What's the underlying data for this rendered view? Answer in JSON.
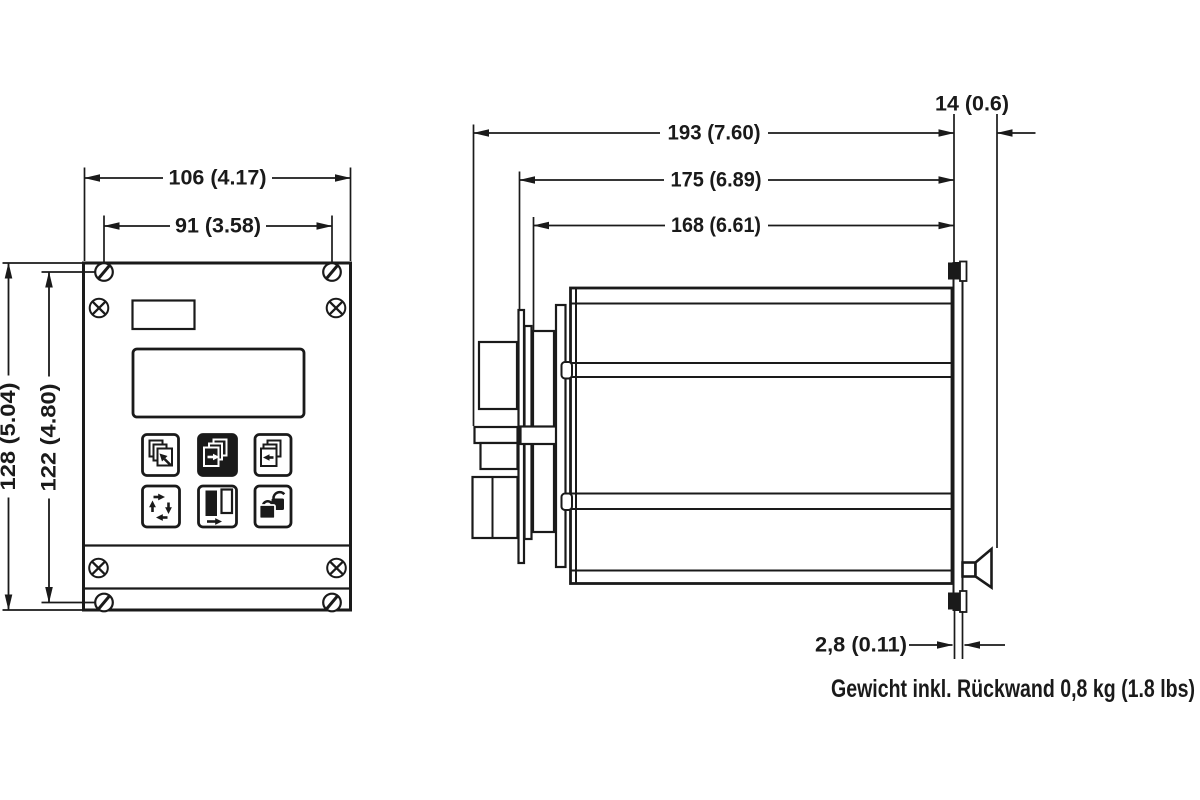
{
  "drawing_title": "panel-mount controller dimension drawing",
  "colors": {
    "ink": "#1a1a1a",
    "background": "#ffffff"
  },
  "front_view": {
    "dims": {
      "width_total": "106 (4.17)",
      "width_fixings": "91 (3.58)",
      "height_total": "128 (5.04)",
      "height_fixings": "122 (4.80)"
    },
    "fasteners": [
      "slotted-screw",
      "slotted-screw",
      "slotted-screw",
      "slotted-screw",
      "cross-screw",
      "cross-screw",
      "cross-screw",
      "cross-screw"
    ],
    "features": [
      "type-label-window",
      "lcd-display-window"
    ],
    "buttons": [
      {
        "icon": "pages-arrow-up-left-icon"
      },
      {
        "icon": "pages-arrow-right-icon",
        "state": "inverted"
      },
      {
        "icon": "pages-arrow-left-icon"
      },
      {
        "icon": "four-arrows-cycle-icon"
      },
      {
        "icon": "page-switch-arrow-right-icon"
      },
      {
        "icon": "lock-unlock-icon"
      }
    ]
  },
  "side_view": {
    "dims": {
      "depth_total": "193 (7.60)",
      "depth_behind_panel": "175 (6.89)",
      "depth_case": "168 (6.61)",
      "front_frame_depth": "14 (0.6)",
      "front_panel_thickness": "2,8 (0.11)"
    },
    "features": [
      "rear-connector-blocks",
      "case-body",
      "mounting-rails",
      "front-panel-plate",
      "panel-clips",
      "mounting-clamp-horn"
    ]
  },
  "note": "Gewicht inkl. Rückwand 0,8 kg (1.8 lbs)"
}
